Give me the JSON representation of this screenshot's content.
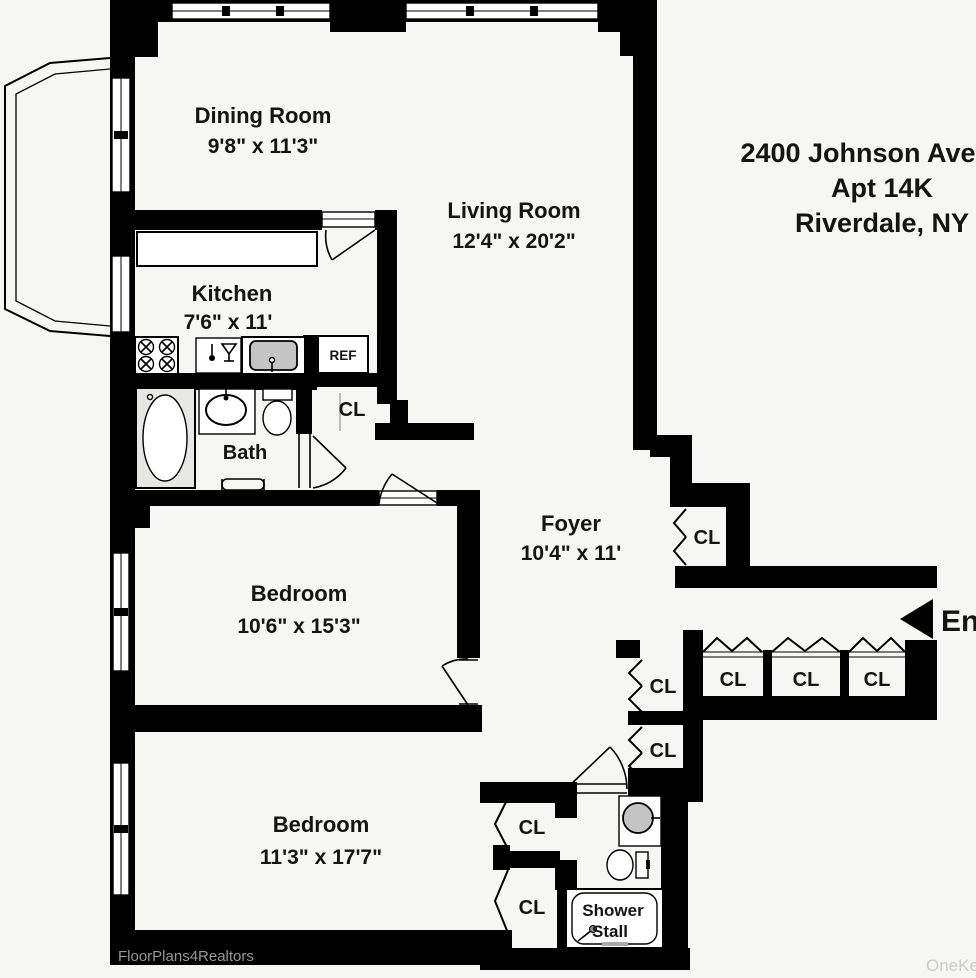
{
  "address": {
    "line1": "2400 Johnson Avenue",
    "line2": "Apt 14K",
    "line3": "Riverdale, NY"
  },
  "rooms": {
    "dining": {
      "name": "Dining Room",
      "dims": "9'8\" x 11'3\""
    },
    "living": {
      "name": "Living Room",
      "dims": "12'4\" x 20'2\""
    },
    "kitchen": {
      "name": "Kitchen",
      "dims": "7'6\" x 11'"
    },
    "bath": {
      "name": "Bath"
    },
    "foyer": {
      "name": "Foyer",
      "dims": "10'4\" x 11'"
    },
    "bedroom1": {
      "name": "Bedroom",
      "dims": "10'6\" x 15'3\""
    },
    "bedroom2": {
      "name": "Bedroom",
      "dims": "11'3\" x 17'7\""
    },
    "shower": {
      "line1": "Shower",
      "line2": "Stall"
    }
  },
  "labels": {
    "closet": "CL",
    "refrigerator": "REF",
    "entry": "Entry"
  },
  "watermarks": {
    "bottom_left": "FloorPlans4Realtors",
    "bottom_right": "OneKey"
  },
  "colors": {
    "wall": "#000000",
    "background": "#f6f6f4",
    "sink_fill": "#c4c4c4",
    "watermark_left": "#979797",
    "watermark_right": "#cccccc"
  }
}
